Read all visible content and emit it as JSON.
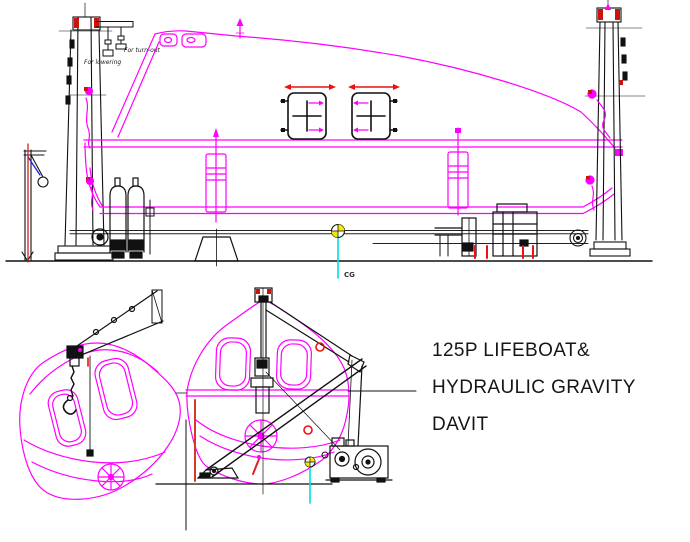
{
  "title": {
    "line1": "125P LIFEBOAT&",
    "line2": "HYDRAULIC GRAVITY",
    "line3": "DAVIT"
  },
  "annotations": {
    "for_lowering": "For lowering",
    "for_turn_out": "For turn-out",
    "cg_label": "CG"
  },
  "colors": {
    "boat_outline": "#ff00ff",
    "structure_lines": "#111111",
    "highlight_red": "#ee1111",
    "cg_leader_cyan": "#00dde8",
    "cg_fill_yellow": "#f2e800",
    "hook_tie_blue": "#2222dd",
    "background": "#ffffff"
  }
}
